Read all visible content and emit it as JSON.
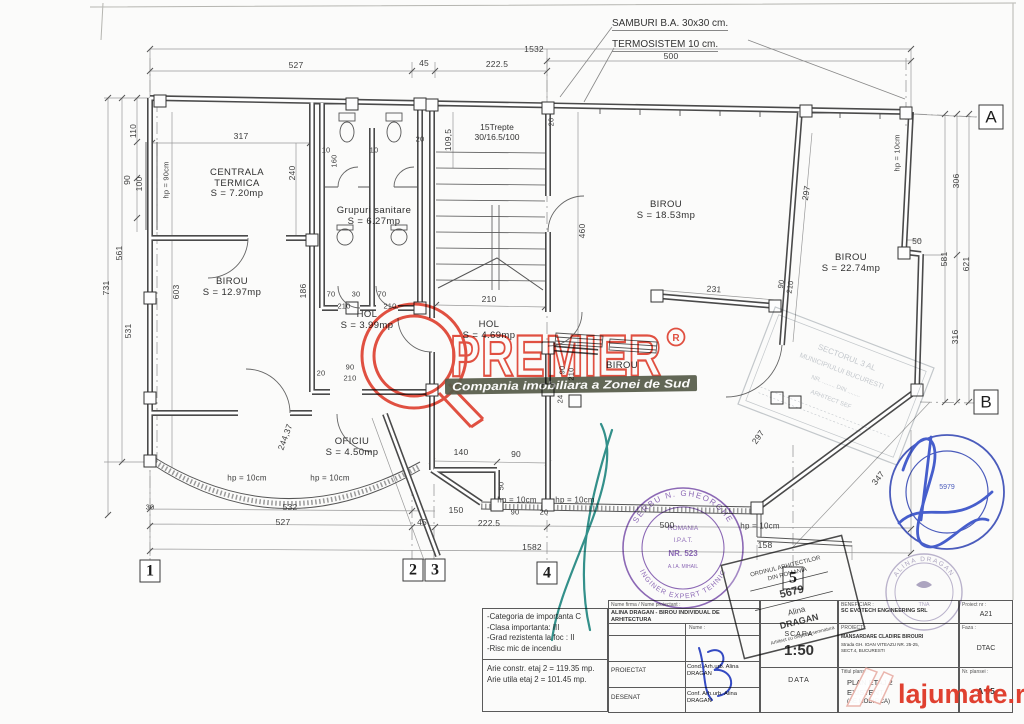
{
  "annotations": {
    "samburi": "SAMBURI B.A. 30x30 cm.",
    "termosistem": "TERMOSISTEM 10 cm."
  },
  "stair": {
    "line1": "15Trepte",
    "line2": "30/16.5/100"
  },
  "rooms": [
    {
      "lines": [
        "CENTRALA",
        "TERMICA",
        "S = 7.20mp"
      ],
      "x": 237,
      "y": 168
    },
    {
      "lines": [
        "Grupuri sanitare",
        "S = 6.27mp"
      ],
      "x": 374,
      "y": 206
    },
    {
      "lines": [
        "BIROU",
        "S = 12.97mp"
      ],
      "x": 232,
      "y": 277
    },
    {
      "lines": [
        "HOL",
        "S = 3.99mp"
      ],
      "x": 367,
      "y": 310
    },
    {
      "lines": [
        "HOL",
        "S = 4.69mp"
      ],
      "x": 489,
      "y": 320
    },
    {
      "lines": [
        "BIROU",
        "S = 18.53mp"
      ],
      "x": 666,
      "y": 200
    },
    {
      "lines": [
        "BIROU",
        "S = 22.74mp"
      ],
      "x": 851,
      "y": 253
    },
    {
      "lines": [
        "BIROU"
      ],
      "x": 622,
      "y": 361
    },
    {
      "lines": [
        "OFICIU",
        "S = 4.50mp"
      ],
      "x": 352,
      "y": 437
    }
  ],
  "dims": [
    {
      "t": "1532",
      "x": 534,
      "y": 49
    },
    {
      "t": "500",
      "x": 671,
      "y": 56
    },
    {
      "t": "527",
      "x": 296,
      "y": 65
    },
    {
      "t": "45",
      "x": 424,
      "y": 63
    },
    {
      "t": "222.5",
      "x": 497,
      "y": 64
    },
    {
      "t": "110",
      "x": 133,
      "y": 131,
      "r": -90
    },
    {
      "t": "90",
      "x": 127,
      "y": 180,
      "r": -90
    },
    {
      "t": "100",
      "x": 139,
      "y": 184,
      "r": -90
    },
    {
      "t": "561",
      "x": 119,
      "y": 253,
      "r": -90
    },
    {
      "t": "731",
      "x": 106,
      "y": 288,
      "r": -90
    },
    {
      "t": "531",
      "x": 128,
      "y": 331,
      "r": -90
    },
    {
      "t": "603",
      "x": 176,
      "y": 292,
      "r": -90
    },
    {
      "t": "hp = 90cm",
      "x": 166,
      "y": 180,
      "r": -90,
      "s": 7.5
    },
    {
      "t": "317",
      "x": 241,
      "y": 136
    },
    {
      "t": "240",
      "x": 292,
      "y": 173,
      "r": -90
    },
    {
      "t": "10",
      "x": 326,
      "y": 150,
      "s": 7.5
    },
    {
      "t": "160",
      "x": 334,
      "y": 161,
      "r": -90,
      "s": 7.5
    },
    {
      "t": "10",
      "x": 374,
      "y": 150,
      "s": 7.5
    },
    {
      "t": "20",
      "x": 420,
      "y": 139,
      "s": 7.5
    },
    {
      "t": "109,5",
      "x": 448,
      "y": 140,
      "r": -90
    },
    {
      "t": "20",
      "x": 551,
      "y": 122,
      "r": -90,
      "s": 7.5
    },
    {
      "t": "460",
      "x": 582,
      "y": 231,
      "r": -90
    },
    {
      "t": "210",
      "x": 489,
      "y": 299
    },
    {
      "t": "70",
      "x": 331,
      "y": 294,
      "s": 7.5
    },
    {
      "t": "30",
      "x": 356,
      "y": 294,
      "s": 7.5
    },
    {
      "t": "70",
      "x": 382,
      "y": 294,
      "s": 7.5
    },
    {
      "t": "210",
      "x": 344,
      "y": 306,
      "s": 7.5
    },
    {
      "t": "210",
      "x": 390,
      "y": 306,
      "s": 7.5
    },
    {
      "t": "186",
      "x": 303,
      "y": 291,
      "r": -90
    },
    {
      "t": "20",
      "x": 321,
      "y": 373,
      "s": 7.5
    },
    {
      "t": "90",
      "x": 350,
      "y": 367,
      "s": 7.5
    },
    {
      "t": "210",
      "x": 350,
      "y": 378,
      "s": 7.5
    },
    {
      "t": "297",
      "x": 806,
      "y": 193,
      "r": -81
    },
    {
      "t": "231",
      "x": 714,
      "y": 289,
      "r": 4
    },
    {
      "t": "90",
      "x": 781,
      "y": 284,
      "r": -81,
      "s": 7.5
    },
    {
      "t": "210",
      "x": 790,
      "y": 287,
      "r": -81,
      "s": 7.5
    },
    {
      "t": "50",
      "x": 917,
      "y": 241
    },
    {
      "t": "306",
      "x": 956,
      "y": 181,
      "r": -90
    },
    {
      "t": "581",
      "x": 944,
      "y": 259,
      "r": -90
    },
    {
      "t": "621",
      "x": 966,
      "y": 264,
      "r": -90
    },
    {
      "t": "316",
      "x": 955,
      "y": 337,
      "r": -90
    },
    {
      "t": "hp = 10cm",
      "x": 897,
      "y": 153,
      "r": -90,
      "s": 7.5
    },
    {
      "t": "244,37",
      "x": 285,
      "y": 437,
      "r": -70
    },
    {
      "t": "140",
      "x": 461,
      "y": 452
    },
    {
      "t": "90",
      "x": 516,
      "y": 454
    },
    {
      "t": "50",
      "x": 501,
      "y": 486,
      "r": -90,
      "s": 7.5
    },
    {
      "t": "90",
      "x": 562,
      "y": 370,
      "r": -90,
      "s": 7.5
    },
    {
      "t": "210",
      "x": 571,
      "y": 374,
      "r": -90,
      "s": 7.5
    },
    {
      "t": "24",
      "x": 560,
      "y": 399,
      "r": -90,
      "s": 7.5
    },
    {
      "t": "hp = 10cm",
      "x": 247,
      "y": 478,
      "s": 8
    },
    {
      "t": "hp = 10cm",
      "x": 330,
      "y": 478,
      "s": 8
    },
    {
      "t": "hp = 10cm",
      "x": 517,
      "y": 500,
      "s": 8
    },
    {
      "t": "hp = 10cm",
      "x": 575,
      "y": 500,
      "s": 8
    },
    {
      "t": "hp = 10cm",
      "x": 760,
      "y": 526,
      "s": 8
    },
    {
      "t": "30",
      "x": 150,
      "y": 507,
      "s": 7.5
    },
    {
      "t": "532",
      "x": 290,
      "y": 507
    },
    {
      "t": "150",
      "x": 456,
      "y": 510
    },
    {
      "t": "90",
      "x": 515,
      "y": 512,
      "s": 7.5
    },
    {
      "t": "20",
      "x": 544,
      "y": 512,
      "s": 7.5
    },
    {
      "t": "527",
      "x": 283,
      "y": 522
    },
    {
      "t": "45",
      "x": 422,
      "y": 522
    },
    {
      "t": "222.5",
      "x": 489,
      "y": 523
    },
    {
      "t": "500",
      "x": 667,
      "y": 525
    },
    {
      "t": "1582",
      "x": 532,
      "y": 547
    },
    {
      "t": "158",
      "x": 765,
      "y": 545
    },
    {
      "t": "347",
      "x": 878,
      "y": 478,
      "r": -52
    },
    {
      "t": "297",
      "x": 758,
      "y": 437,
      "r": -55
    }
  ],
  "grid_markers": [
    {
      "t": "1",
      "x": 150,
      "y": 571,
      "k": "num"
    },
    {
      "t": "2",
      "x": 413,
      "y": 570,
      "k": "num"
    },
    {
      "t": "3",
      "x": 435,
      "y": 570,
      "k": "num"
    },
    {
      "t": "4",
      "x": 547,
      "y": 573,
      "k": "num"
    },
    {
      "t": "5",
      "x": 793,
      "y": 578,
      "k": "num"
    },
    {
      "t": "A",
      "x": 991,
      "y": 117,
      "k": "alpha"
    },
    {
      "t": "B",
      "x": 986,
      "y": 402,
      "k": "alpha"
    }
  ],
  "watermarks": {
    "premier": {
      "text": "PREMIER",
      "reg_symbol": "R",
      "tagline": "Compania imobiliara a Zonei de Sud",
      "color": "#e13a28"
    },
    "lajumate": {
      "text": "lajumate.ro",
      "color": "#df3826"
    }
  },
  "stamps": {
    "engineer_round": {
      "ring_top": "SERBU N. GHEORGHE",
      "ring_bottom": "INGINER EXPERT TEHNIC",
      "center1": "ROMANIA",
      "center2": "I.P.A.T.",
      "center3": "NR. 523",
      "center4": "A.I.A. MIHAIL"
    },
    "oar_square": {
      "line1": "ORDINUL ARHITECTILOR",
      "line2": "DIN ROMANIA",
      "number": "5679",
      "name1": "Alina",
      "name2": "DRAGAN",
      "line3": "Arhitect cu drept de semnatura"
    },
    "sector": {
      "line1": "SECTORUL 3 AL",
      "line2": "MUNICIPIULUI BUCURESTI",
      "line3": "NR. ........ DIN ........",
      "line4": "ARHITECT SEF"
    },
    "architect_round": {
      "ring": "ALINA DRAGAN",
      "center": "TNA"
    },
    "verifier_round": {
      "number": "5979"
    }
  },
  "titleblock": {
    "notes": [
      "-Categoria de importanta C",
      "-Clasa importanta: III",
      "-Grad rezistenta la foc : II",
      "-Risc mic de incendiu"
    ],
    "areas": [
      "Arie constr. etaj 2 = 119.35 mp.",
      "Arie utila etaj 2 = 101.45 mp."
    ],
    "firm_label": "Nume firma / Nume proiectant :",
    "firm": "ALINA DRAGAN - BIROU INDIVIDUAL DE ARHITECTURA",
    "nume_header": "Nume :",
    "row1_label": "PROIECTAT",
    "row1_value": "Cond. Arh.urb. Alina DRAGAN",
    "row2_label": "DESENAT",
    "row2_value": "Conf. Arh.urb. Alina DRAGAN",
    "scara_label": "SCARA",
    "scara_value": "1:50",
    "data_label": "DATA",
    "beneficiar_label": "BENEFICIAR :",
    "beneficiar": "SC EVOTECH ENGINEERING SRL",
    "proiect_label": "PROIECT :",
    "proiect": "MANSARDARE CLADIRE BIROURI",
    "adresa1": "Strada GH. IOAN VITEAZU NR. 25-25,",
    "adresa2": "SECT.4, BUCURESTI",
    "titlu_label": "Titlul plansei :",
    "titlu1": "PLAN ETAJ 2",
    "titlu2": "EXISTENT",
    "titlu3": "(SE MODIFICA)",
    "proiect_nr_label": "Proiect nr :",
    "proiect_nr": "A21",
    "faza_label": "Faza :",
    "faza": "DTAC",
    "plansa_label": "Nr. plansei :",
    "plansa": "A 05"
  }
}
